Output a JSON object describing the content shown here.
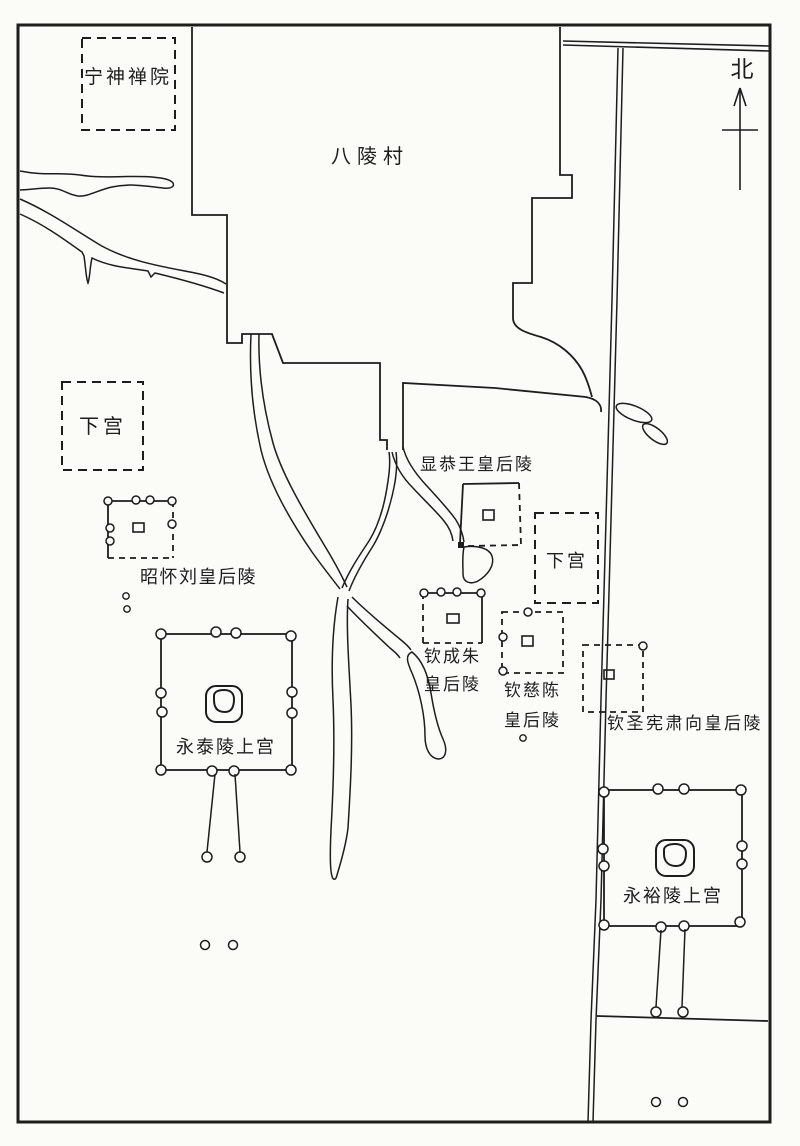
{
  "map": {
    "labels": {
      "ningshen_temple": "宁神禅院",
      "baling_village": "八陵村",
      "north_indicator": "北",
      "xiagong_left": "下宫",
      "xiagong_right": "下宫",
      "zhaohuai_tomb": "昭怀刘皇后陵",
      "xiangong_tomb": "显恭王皇后陵",
      "qinchengzhu_tomb_line1": "钦成朱",
      "qinchengzhu_tomb_line2": "皇后陵",
      "qincichen_tomb_line1": "钦慈陈",
      "qincichen_tomb_line2": "皇后陵",
      "qinshengxiansu_tomb": "钦圣宪肃向皇后陵",
      "yongtai_upper_palace": "永泰陵上宫",
      "yongyu_upper_palace": "永裕陵上宫"
    },
    "colors": {
      "ink": "#1d1d1b",
      "paper": "#fbfbf8"
    }
  }
}
